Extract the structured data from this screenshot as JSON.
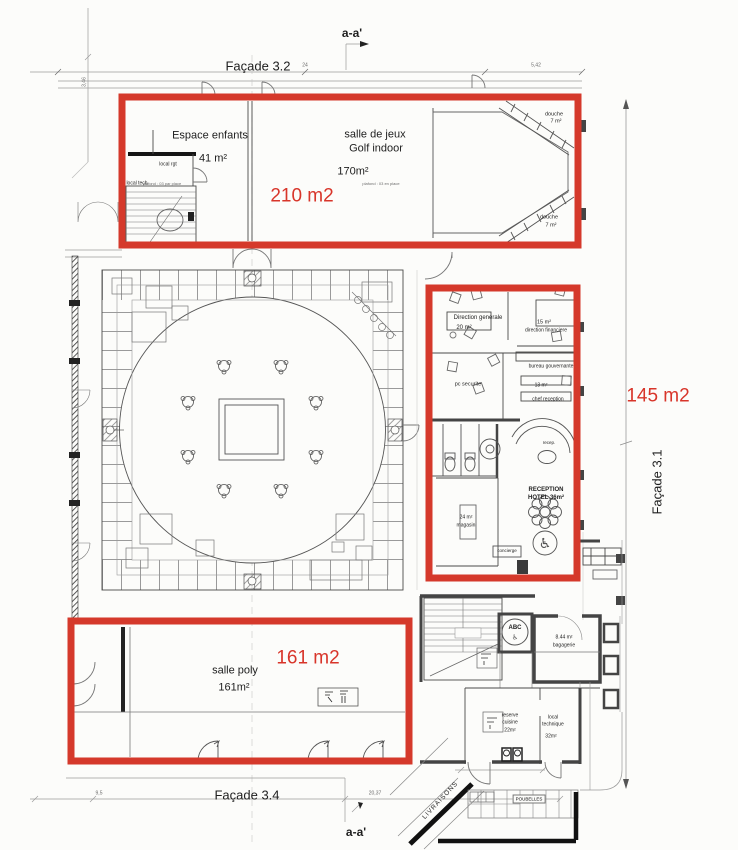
{
  "colors": {
    "highlight": "#d5392b",
    "annotation_text": "#d8352a"
  },
  "plan": {
    "highlights": {
      "top": "210 m2",
      "right": "145 m2",
      "bottom": "161 m2"
    },
    "facades": {
      "f32": "Façade 3.2",
      "f31": "Façade 3.1",
      "f34": "Façade 3.4"
    },
    "sections": {
      "top": "a-a'",
      "bottom": "a-a'"
    },
    "dims": {
      "d24": "24",
      "d542": "5,42",
      "d346": "3,46",
      "d95": "9,5",
      "d2037": "20,37"
    },
    "rooms": {
      "espace_enfants": {
        "name": "Espace enfants",
        "area": "41 m²",
        "note": "plafond : 03 par place"
      },
      "salle_de_jeux": {
        "name": "salle de jeux",
        "name2": "Golf indoor",
        "area": "170m²",
        "note": "plafond : 03 en place"
      },
      "local_rgt": {
        "name": "local rgt"
      },
      "local_tech": {
        "name": "local tech"
      },
      "douche_haut": {
        "name": "douche",
        "area": "7 m²"
      },
      "douche_bas": {
        "name": "douche",
        "area": "7 m²"
      },
      "direction_generale": {
        "name": "Direction generale",
        "area": "20 m²"
      },
      "direction_financiere": {
        "area": "15 m²",
        "name": "direction financiere"
      },
      "bureau_gouvernante": {
        "name": "bureau gouvernante"
      },
      "pc_securite": {
        "name": "pc securite"
      },
      "chef_reception": {
        "area": "13 m²",
        "name": "chef reception"
      },
      "recep": {
        "name": "recep."
      },
      "reception": {
        "name": "RECEPTION",
        "name2": "HOTEL  36m²"
      },
      "magasin": {
        "area": "24 m²",
        "name": "magasin"
      },
      "concierge": {
        "name": "concierge"
      },
      "salle_poly": {
        "name": "salle poly",
        "area": "161m²"
      },
      "ascenseur": {
        "name": "ABC"
      },
      "bagagerie": {
        "area": "8.44 m²",
        "name": "bagagerie"
      },
      "reserve_cuisine": {
        "name": "reserve",
        "name2": "cuisine",
        "area": "22m²"
      },
      "local_technique": {
        "name": "local",
        "name2": "technique",
        "area": "32m²"
      },
      "livraisons": {
        "name": "LIVRAISONS"
      },
      "poubelles": {
        "name": "POUBELLES"
      }
    },
    "icons": {
      "wheelchair": "♿",
      "wheelchair_small": "♿"
    }
  }
}
